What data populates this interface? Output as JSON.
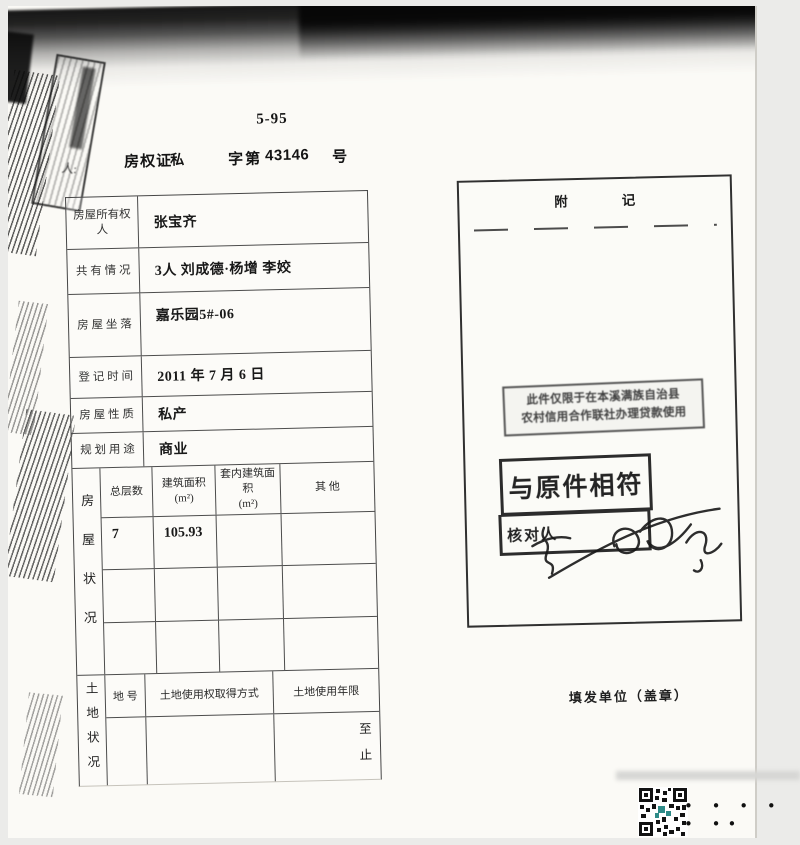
{
  "page": {
    "code_number": "5-95",
    "title": {
      "doc_type": "房权证",
      "category": "私",
      "series_label": "字第",
      "serial_number": "43146",
      "suffix": "号"
    }
  },
  "owner_table": {
    "rows": [
      {
        "label": "房屋所有权人",
        "value": "张宝齐"
      },
      {
        "label": "共 有 情 况",
        "value": "3人 刘成德·杨增 李姣"
      },
      {
        "label": "房 屋 坐 落",
        "value": "嘉乐园5#-06"
      },
      {
        "label": "登 记 时 间",
        "value": "2011 年 7 月 6 日"
      },
      {
        "label": "房 屋 性 质",
        "value": "私产"
      },
      {
        "label": "规 划 用 途",
        "value": "商业"
      }
    ]
  },
  "building_section": {
    "side_label": "房屋状况",
    "headers": [
      "总层数",
      "建筑面积\n(m²)",
      "套内建筑面积\n(m²)",
      "其  他"
    ],
    "data_rows": [
      [
        "7",
        "105.93",
        "",
        ""
      ],
      [
        "",
        "",
        "",
        ""
      ],
      [
        "",
        "",
        "",
        ""
      ]
    ]
  },
  "land_section": {
    "side_label": "土地状况",
    "headers": [
      "地 号",
      "土地使用权取得方式",
      "土地使用年限"
    ],
    "term_from": "至",
    "term_to": "止"
  },
  "remarks_panel": {
    "title": "附                记",
    "loan_stamp_line1": "此件仅限于在本溪满族自治县",
    "loan_stamp_line2": "农村信用合作联社办理贷款使用",
    "match_stamp": "与原件相符",
    "checker_label": "核对人",
    "issuer_label": "填发单位（盖章）"
  },
  "artifacts": {
    "margin_glyphs": "人:",
    "dots": "• • • • • ••"
  }
}
